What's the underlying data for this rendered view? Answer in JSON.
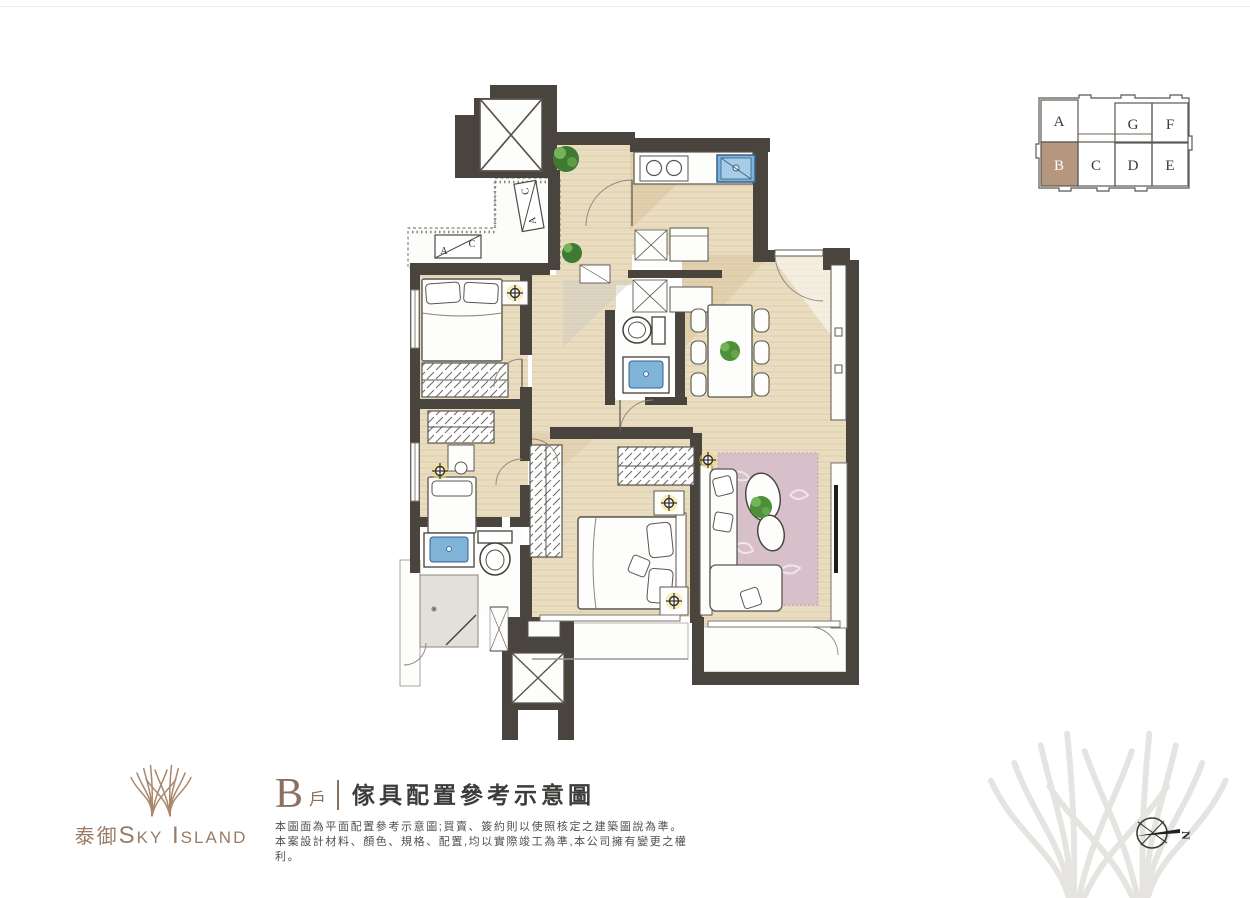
{
  "key_plan": {
    "highlight_color": "#b5977f",
    "cells": {
      "a": "A",
      "g": "G",
      "f": "F",
      "b": "B",
      "c": "C",
      "d": "D",
      "e": "E"
    }
  },
  "floor_plan": {
    "ac_label_a": "A",
    "ac_label_c": "C"
  },
  "compass": {
    "north_label": "N"
  },
  "brand": {
    "logo_cn": "泰御",
    "logo_en": "Sky Island"
  },
  "title": {
    "unit": "B",
    "unit_suffix": "戶",
    "heading": "傢具配置參考示意圖"
  },
  "disclaimer": {
    "line1": "本圖面為平面配置參考示意圖;買賣、簽約則以使照核定之建築圖說為準。",
    "line2": "本案設計材料、顏色、規格、配置,均以實際竣工為準,本公司擁有變更之權利。"
  },
  "colors": {
    "wall": "#4a443e",
    "wood": "#eadec3",
    "fixture_blue": "#7fb3d8",
    "rug_pink": "#d7c0ca",
    "brand_bronze": "#9b7b66"
  }
}
